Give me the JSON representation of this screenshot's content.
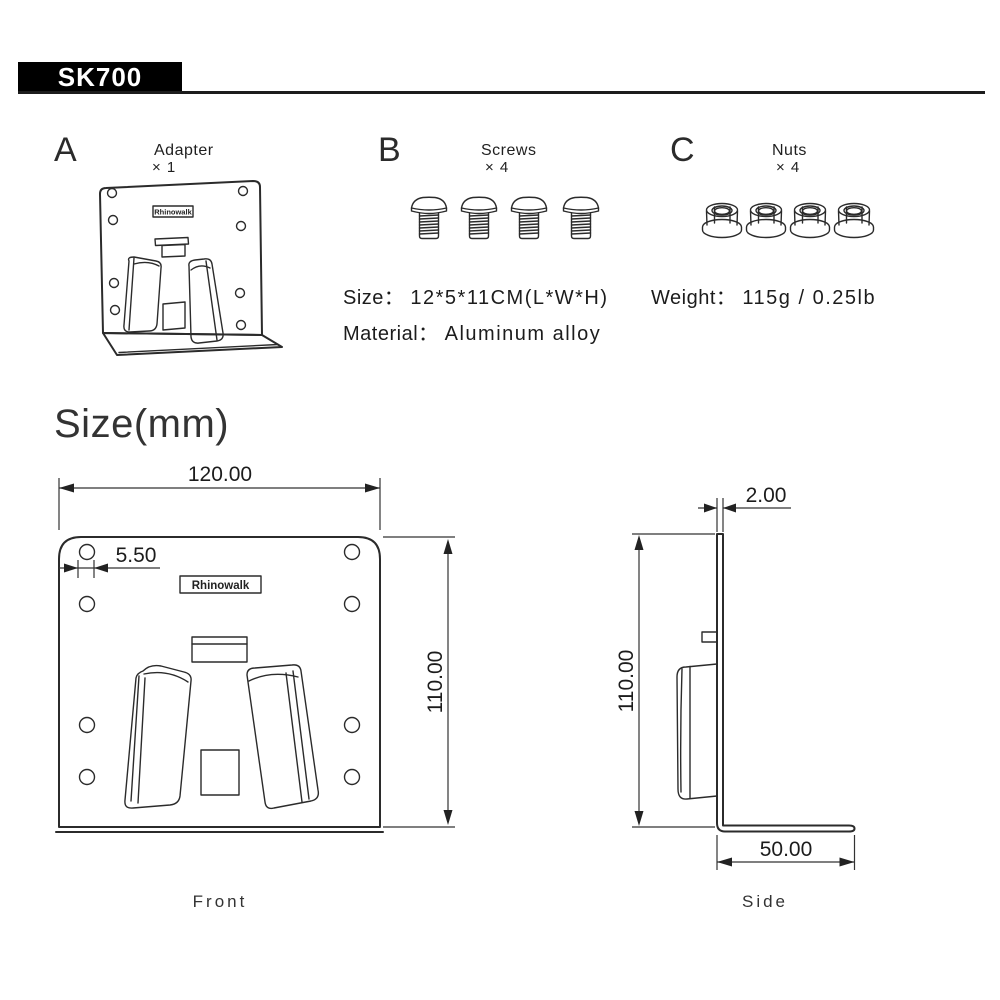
{
  "header": {
    "model": "SK700"
  },
  "brand": "Rhinowalk",
  "parts": [
    {
      "letter": "A",
      "name": "Adapter",
      "qty": "× 1"
    },
    {
      "letter": "B",
      "name": "Screws",
      "qty": "× 4"
    },
    {
      "letter": "C",
      "name": "Nuts",
      "qty": "× 4"
    }
  ],
  "specs": {
    "size_label": "Size：",
    "size_value": "12*5*11CM(L*W*H)",
    "material_label": "Material：",
    "material_value": "Aluminum alloy",
    "weight_label": "Weight：",
    "weight_value": "115g / 0.25lb"
  },
  "size_section": {
    "title": "Size(mm)",
    "front": {
      "label": "Front",
      "width": "120.00",
      "hole_diameter": "5.50",
      "height": "110.00"
    },
    "side": {
      "label": "Side",
      "thickness": "2.00",
      "height": "110.00",
      "depth": "50.00"
    }
  }
}
